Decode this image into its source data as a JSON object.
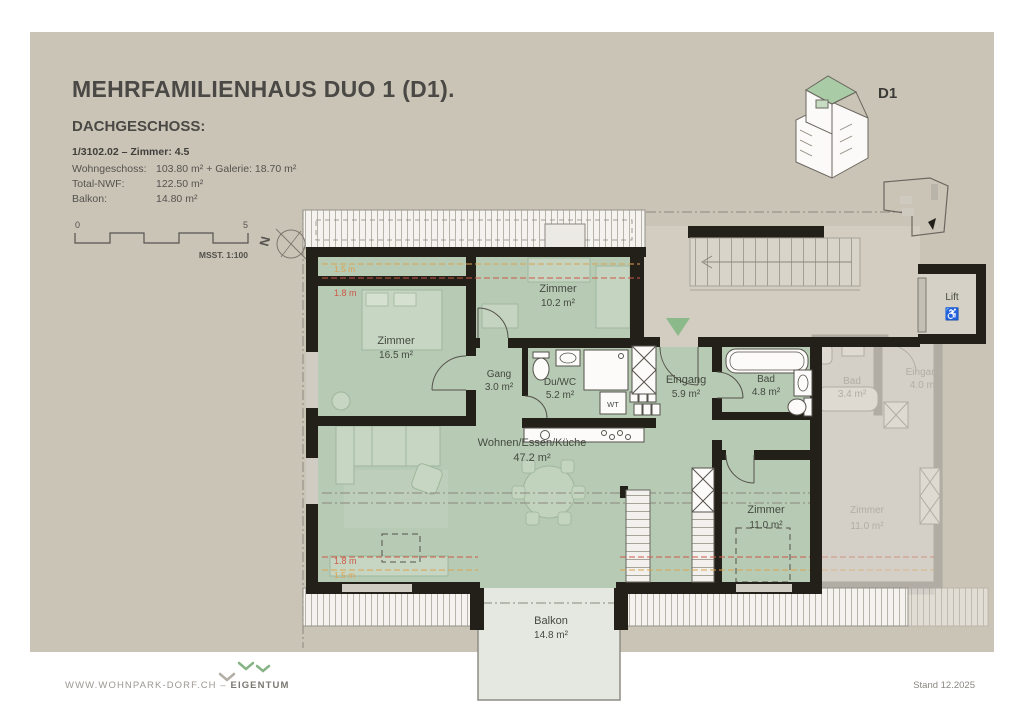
{
  "header": {
    "title": "MEHRFAMILIENHAUS DUO 1 (D1).",
    "subtitle": "DACHGESCHOSS:"
  },
  "info": {
    "unit_line": "1/3102.02 – Zimmer: 4.5",
    "rows": [
      {
        "label": "Wohngeschoss:",
        "value": "103.80 m² + Galerie: 18.70 m²"
      },
      {
        "label": "Total-NWF:",
        "value": "122.50 m²"
      },
      {
        "label": "Balkon:",
        "value": "14.80 m²"
      }
    ]
  },
  "scale_bar": {
    "start": "0",
    "end": "5",
    "caption": "MSST. 1:100"
  },
  "compass": {
    "label": "N"
  },
  "key_plan": {
    "label": "D1"
  },
  "rooms": {
    "zimmer1": {
      "name": "Zimmer",
      "area": "16.5 m²"
    },
    "zimmer2": {
      "name": "Zimmer",
      "area": "10.2 m²"
    },
    "gang": {
      "name": "Gang",
      "area": "3.0 m²"
    },
    "du_wc": {
      "name": "Du/WC",
      "area": "5.2 m²"
    },
    "eingang": {
      "name": "Eingang",
      "area": "5.9 m²"
    },
    "bad": {
      "name": "Bad",
      "area": "4.8 m²"
    },
    "wohnen": {
      "name": "Wohnen/Essen/Küche",
      "area": "47.2 m²"
    },
    "zimmer3": {
      "name": "Zimmer",
      "area": "11.0 m²"
    },
    "balkon": {
      "name": "Balkon",
      "area": "14.8 m²"
    },
    "lift": {
      "name": "Lift"
    }
  },
  "annotations": {
    "height_top_1": "1.5 m",
    "height_top_2": "1.8 m",
    "height_bottom_1": "1.8 m",
    "height_bottom_2": "1.5 m",
    "washer_tower": "WT",
    "wheelchair_icon": "♿"
  },
  "neighbor": {
    "bad": {
      "name": "Bad",
      "area": "3.4 m²"
    },
    "eingang": {
      "name": "Eingang",
      "area": "4.0 m²"
    },
    "zimmer": {
      "name": "Zimmer",
      "area": "11.0 m²"
    }
  },
  "footer": {
    "website": "WWW.WOHNPARK-DORF.CH –",
    "tag": "EIGENTUM",
    "date": "Stand 12.2025"
  },
  "colors": {
    "canvas": "#cac4b7",
    "room_green": "#b6cab4",
    "wall": "#232019",
    "balcony": "#e4e8e0",
    "accent_red": "#cf5846",
    "accent_orange": "#dfa14e",
    "marker_green": "#8cb98a",
    "key_roof_green": "#a9cba6"
  }
}
